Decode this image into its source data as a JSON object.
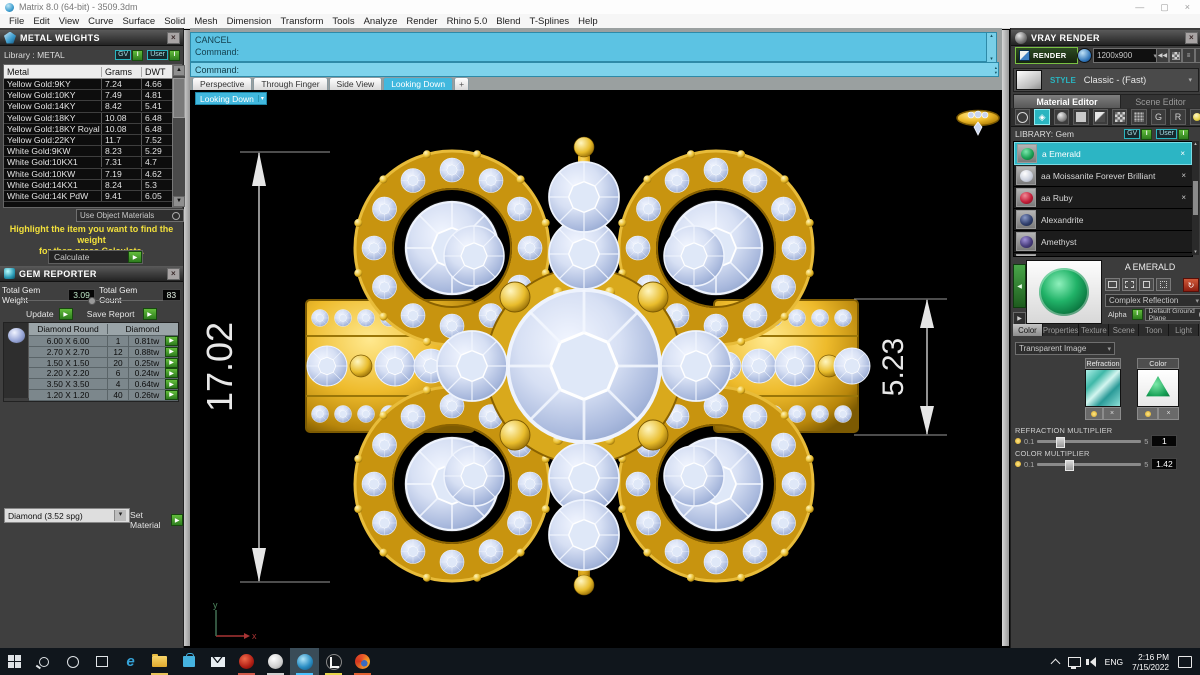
{
  "window": {
    "title": "Matrix 8.0 (64-bit) - 3509.3dm"
  },
  "menu": {
    "items": [
      "File",
      "Edit",
      "View",
      "Curve",
      "Surface",
      "Solid",
      "Mesh",
      "Dimension",
      "Transform",
      "Tools",
      "Analyze",
      "Render",
      "Rhino 5.0",
      "Blend",
      "T-Splines",
      "Help"
    ]
  },
  "toggles": {
    "gv": "GV",
    "user": "User"
  },
  "icons": {
    "close": "×",
    "arrow": "▶",
    "caret": "▾",
    "up": "▲",
    "down": "▼",
    "on": "I",
    "back": "◀",
    "rewind": "◀◀",
    "lines": "≡",
    "text_tool": "A",
    "gem": "◈",
    "refresh": "↻",
    "plus": "+",
    "x": "×",
    "spin_up": "▴",
    "spin_down": "▾"
  },
  "metal_weights": {
    "title": "METAL WEIGHTS",
    "library": "Library :  METAL",
    "columns": [
      "Metal",
      "Grams",
      "DWT"
    ],
    "rows": [
      {
        "metal": "Yellow Gold:9KY",
        "grams": "7.24",
        "dwt": "4.66"
      },
      {
        "metal": "Yellow Gold:10KY",
        "grams": "7.49",
        "dwt": "4.81"
      },
      {
        "metal": "Yellow Gold:14KY",
        "grams": "8.42",
        "dwt": "5.41"
      },
      {
        "metal": "Yellow Gold:18KY",
        "grams": "10.08",
        "dwt": "6.48"
      },
      {
        "metal": "Yellow Gold:18KY Royal",
        "grams": "10.08",
        "dwt": "6.48"
      },
      {
        "metal": "Yellow Gold:22KY",
        "grams": "11.7",
        "dwt": "7.52"
      },
      {
        "metal": "White Gold:9KW",
        "grams": "8.23",
        "dwt": "5.29"
      },
      {
        "metal": "White Gold:10KX1",
        "grams": "7.31",
        "dwt": "4.7"
      },
      {
        "metal": "White Gold:10KW",
        "grams": "7.19",
        "dwt": "4.62"
      },
      {
        "metal": "White Gold:14KX1",
        "grams": "8.24",
        "dwt": "5.3"
      },
      {
        "metal": "White Gold:14K PdW",
        "grams": "9.41",
        "dwt": "6.05"
      }
    ],
    "materials_dropdown": "Use Object Materials",
    "hint_line1": "Highlight the item you want to find the weight",
    "hint_line2": "for then press Calculate.",
    "calculate": "Calculate"
  },
  "gem_reporter": {
    "title": "GEM REPORTER",
    "total_weight_label": "Total Gem Weight",
    "total_weight": "3.09",
    "total_count_label": "Total Gem Count",
    "total_count": "83",
    "update": "Update",
    "save_report": "Save Report",
    "columns": [
      "Diamond Round",
      "Diamond"
    ],
    "rows": [
      {
        "size": "6.00 X 6.00",
        "count": "1",
        "weight": "0.81tw"
      },
      {
        "size": "2.70 X 2.70",
        "count": "12",
        "weight": "0.88tw"
      },
      {
        "size": "1.50 X 1.50",
        "count": "20",
        "weight": "0.25tw"
      },
      {
        "size": "2.20 X 2.20",
        "count": "6",
        "weight": "0.24tw"
      },
      {
        "size": "3.50 X 3.50",
        "count": "4",
        "weight": "0.64tw"
      },
      {
        "size": "1.20 X 1.20",
        "count": "40",
        "weight": "0.26tw"
      }
    ],
    "material_dropdown": "Diamond    (3.52 spg)",
    "set_material": "Set Material"
  },
  "command": {
    "line1": "CANCEL",
    "line2": "Command:",
    "prompt": "Command:"
  },
  "viewport": {
    "tabs": [
      "Perspective",
      "Through Finger",
      "Side View",
      "Looking Down"
    ],
    "active_tab": "Looking Down",
    "view_label": "Looking Down",
    "dim_height": "17.02",
    "dim_width": "5.23",
    "axis_x": "x",
    "axis_y": "y"
  },
  "vray": {
    "title": "VRAY RENDER",
    "render": "RENDER",
    "resolution": "1200x900",
    "style_label": "STYLE",
    "style_value": "Classic - (Fast)",
    "tabs": [
      "Material Editor",
      "Scene Editor"
    ],
    "library": "LIBRARY: Gem",
    "materials": [
      {
        "name": "a Emerald",
        "swatch": "#1da257"
      },
      {
        "name": "aa Moissanite Forever Brilliant",
        "swatch": "#e4e7ee"
      },
      {
        "name": "aa Ruby",
        "swatch": "#c41f3a"
      },
      {
        "name": "Alexandrite",
        "swatch": "#31406e"
      },
      {
        "name": "Amethyst",
        "swatch": "#4a3f7e"
      }
    ],
    "selected_material": "A  EMERALD",
    "reflection_dropdown": "Complex Reflection",
    "alpha_label": "Alpha",
    "ground_dropdown": "Default Ground Plane",
    "detail_tabs": [
      "Color",
      "Properties",
      "Texture",
      "Scene",
      "Toon",
      "Light"
    ],
    "transparent_dropdown": "Transparent Image",
    "refraction_swatch_label": "Refraction",
    "color_swatch_label": "Color",
    "refraction_multiplier": {
      "label": "REFRACTION MULTIPLIER",
      "min": "0.1",
      "max": "5",
      "value": "1"
    },
    "color_multiplier": {
      "label": "COLOR MULTIPLIER",
      "min": "0.1",
      "max": "5",
      "value": "1.42"
    }
  },
  "taskbar": {
    "language": "ENG",
    "time": "2:16 PM",
    "date": "7/15/2022"
  },
  "colors": {
    "accent_cyan": "#3db6dd",
    "teal": "#2ab5c0",
    "gold": "#e2af25",
    "diamond": "#c3cfec",
    "green_button": "#4aa52e",
    "selection": "#2cb5c4"
  }
}
